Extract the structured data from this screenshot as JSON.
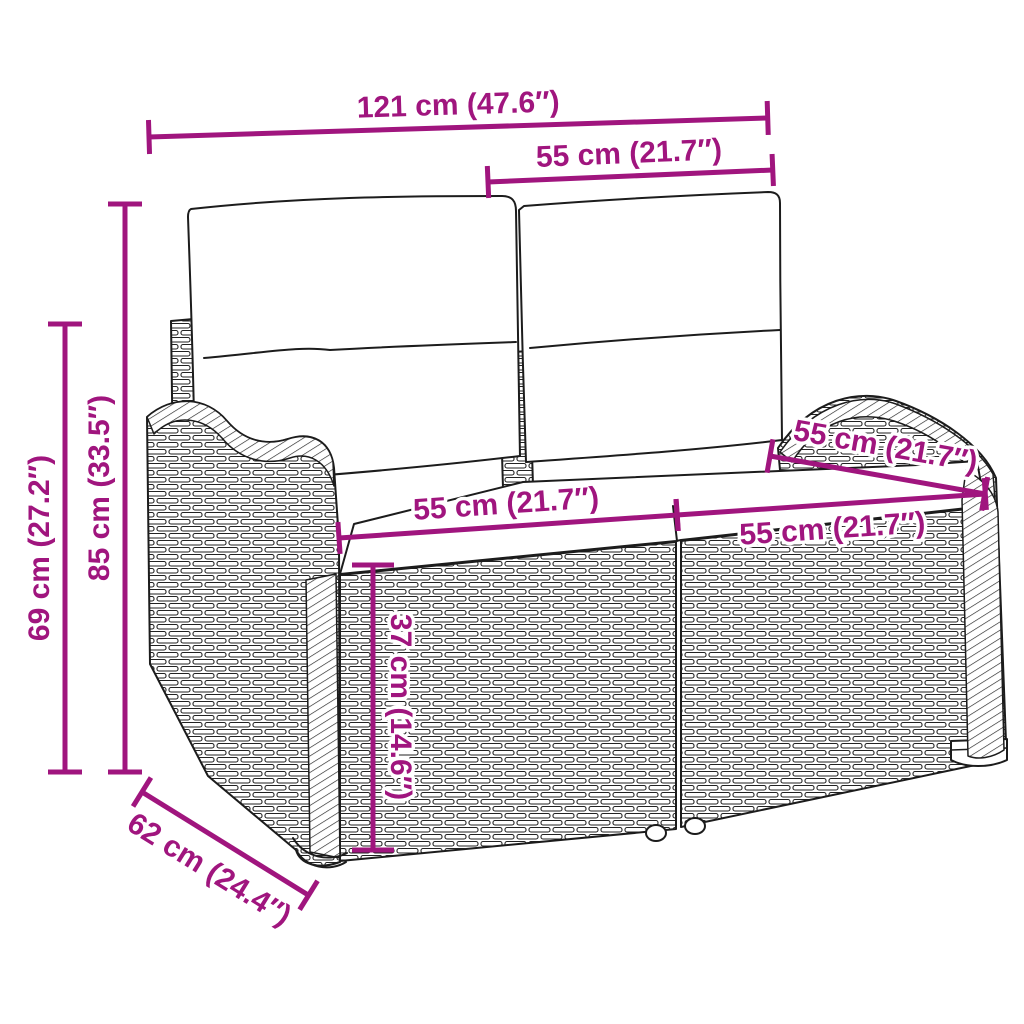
{
  "page": {
    "background": "#FFFFFF"
  },
  "colors": {
    "dimension_accent": "#A0157E",
    "line_art": "#1C1C1C",
    "cushion_fill": "#FFFFFF"
  },
  "dimensions": {
    "total_width": {
      "label": "121 cm (47.6″)"
    },
    "backrest_width": {
      "label": "55 cm (21.7″)"
    },
    "total_height": {
      "label": "85 cm (33.5″)"
    },
    "armrest_height": {
      "label": "69 cm (27.2″)"
    },
    "seat_width_left": {
      "label": "55 cm (21.7″)"
    },
    "seat_width_right": {
      "label": "55 cm (21.7″)"
    },
    "seat_depth": {
      "label": "55 cm (21.7″)"
    },
    "seat_height": {
      "label": "37 cm (14.6″)"
    },
    "total_depth": {
      "label": "62 cm (24.4″)"
    }
  }
}
